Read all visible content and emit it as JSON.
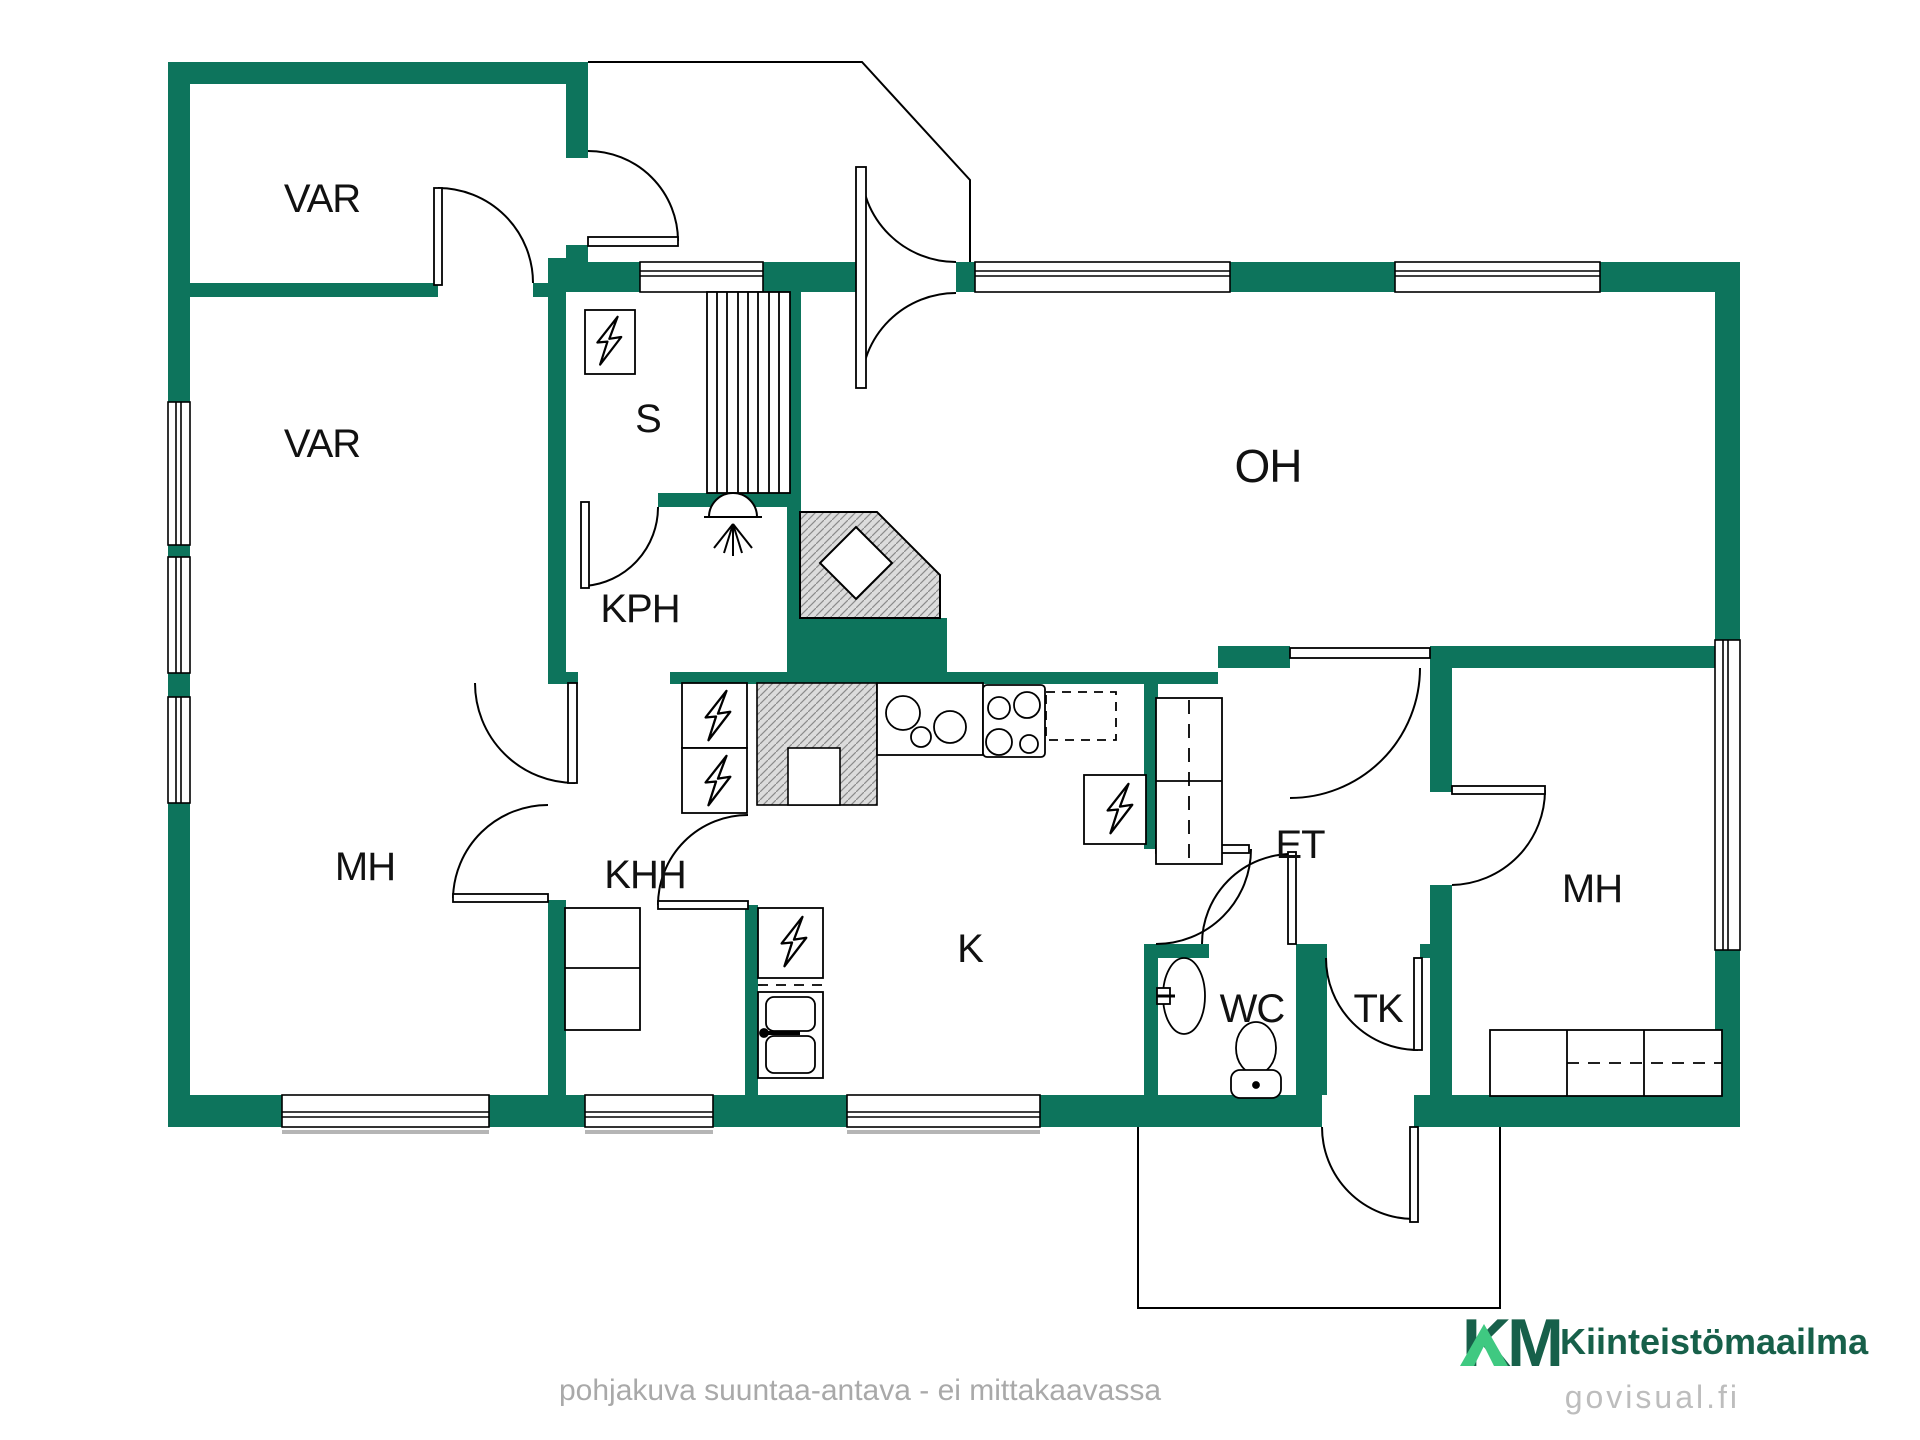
{
  "rooms": {
    "var_top": {
      "label": "VAR"
    },
    "var_bottom": {
      "label": "VAR"
    },
    "sauna": {
      "label": "S"
    },
    "kph": {
      "label": "KPH"
    },
    "mh_left": {
      "label": "MH"
    },
    "khh": {
      "label": "KHH"
    },
    "kitchen": {
      "label": "K"
    },
    "oh": {
      "label": "OH"
    },
    "et": {
      "label": "ET"
    },
    "wc": {
      "label": "WC"
    },
    "tk": {
      "label": "TK"
    },
    "mh_right": {
      "label": "MH"
    }
  },
  "footer": {
    "disclaimer": "pohjakuva suuntaa-antava - ei mittakaavassa",
    "watermark": "govisual.fi"
  },
  "brand": {
    "mark": "KM",
    "name": "Kiinteistömaailma"
  },
  "colors": {
    "wall": "#0d745c",
    "line": "#000000",
    "hatch_bg": "#dcdcdc",
    "hatch_line": "#8a8a8a",
    "brand_dark": "#17604a",
    "brand_light": "#3fc981",
    "muted_text": "#a9a9a9"
  }
}
